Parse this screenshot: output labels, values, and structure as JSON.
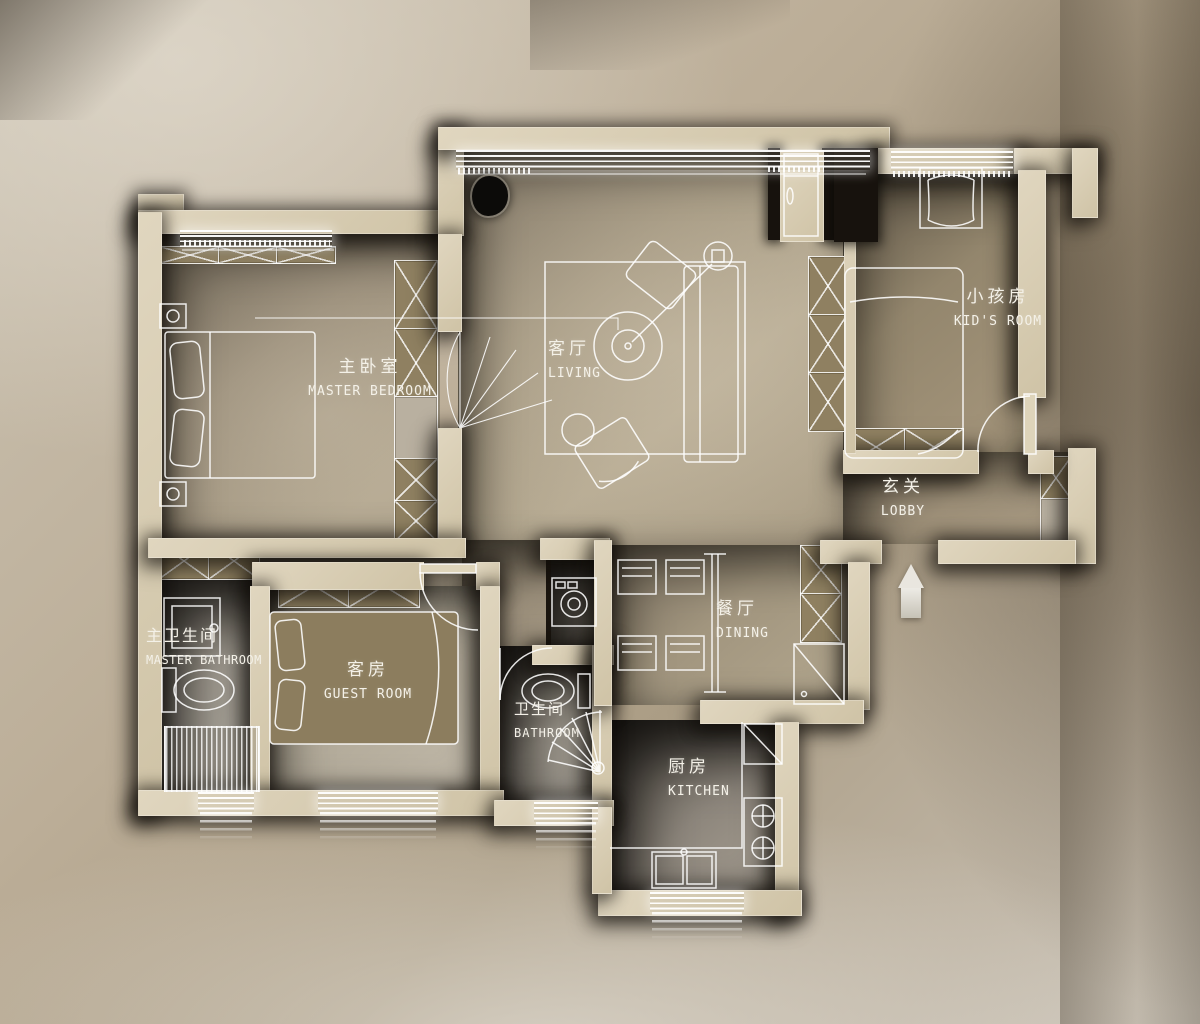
{
  "plan_title": "apartment-floor-plan",
  "rooms": [
    {
      "id": "master-bedroom",
      "zh": "主卧室",
      "en": "MASTER BEDROOM"
    },
    {
      "id": "living",
      "zh": "客厅",
      "en": "LIVING"
    },
    {
      "id": "kids-room",
      "zh": "小孩房",
      "en": "KID'S ROOM"
    },
    {
      "id": "lobby",
      "zh": "玄关",
      "en": "LOBBY"
    },
    {
      "id": "dining",
      "zh": "餐厅",
      "en": "DINING"
    },
    {
      "id": "master-bathroom",
      "zh": "主卫生间",
      "en": "MASTER BATHROOM"
    },
    {
      "id": "guest-room",
      "zh": "客房",
      "en": "GUEST ROOM"
    },
    {
      "id": "bathroom",
      "zh": "卫生间",
      "en": "BATHROOM"
    },
    {
      "id": "kitchen",
      "zh": "厨房",
      "en": "KITCHEN"
    }
  ],
  "colors": {
    "backdrop": "#b7aa95",
    "wall": "#d8cdb3",
    "cabinet_fill": "#8f8061",
    "furniture_line": "#ffffff",
    "shadow": "#15100b",
    "label_text": "#f4f1e8"
  },
  "icons": {
    "entry_arrow": "points-up-into-lobby",
    "plant": "black-plant-blob-top-of-living"
  }
}
